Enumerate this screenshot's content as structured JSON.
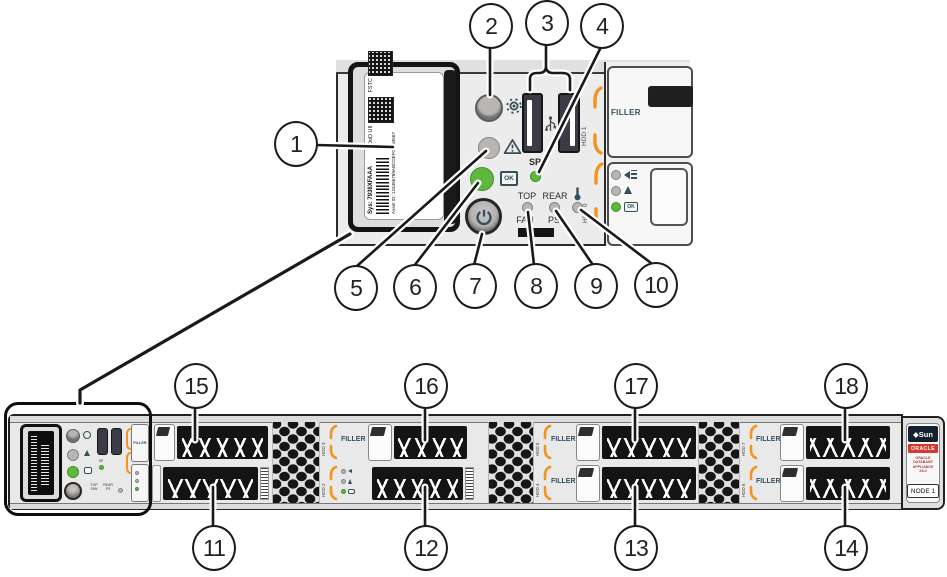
{
  "callouts": [
    "1",
    "2",
    "3",
    "4",
    "5",
    "6",
    "7",
    "8",
    "9",
    "10",
    "11",
    "12",
    "13",
    "14",
    "15",
    "16",
    "17",
    "18"
  ],
  "service_label": {
    "fstc_caption": "FSTC",
    "dod_caption": "DoD UII",
    "sys_serial": "Sys: 7938XFAAA",
    "asset_id": "Asset ID: 123456789ABCDEF01234567"
  },
  "control_panel": {
    "sp_label": "SP",
    "top_label": "TOP",
    "fan_label": "FAN",
    "rear_label": "REAR",
    "ps_label": "PS",
    "ok_label": "OK",
    "filler_label": "FILLER",
    "hdd1_label": "HDD 1",
    "hdd0_label": "HDD 0"
  },
  "chassis": {
    "filler_label": "FILLER",
    "vent_labels": [
      [
        "HDD 3",
        "HDD 2"
      ],
      [
        "HDD 5",
        "HDD 4"
      ],
      [
        "HDD 7",
        "HDD 6"
      ]
    ],
    "badge": {
      "sun": "◆Sun",
      "oracle": "ORACLE",
      "product": [
        "ORACLE",
        "DATABASE",
        "APPLIANCE",
        "X3-2"
      ],
      "node": "NODE 1"
    }
  },
  "colors": {
    "accent_orange": "#F2941E",
    "led_green": "#5CB83E",
    "oracle_red": "#D63A2F",
    "icon_teal": "#33505C"
  }
}
